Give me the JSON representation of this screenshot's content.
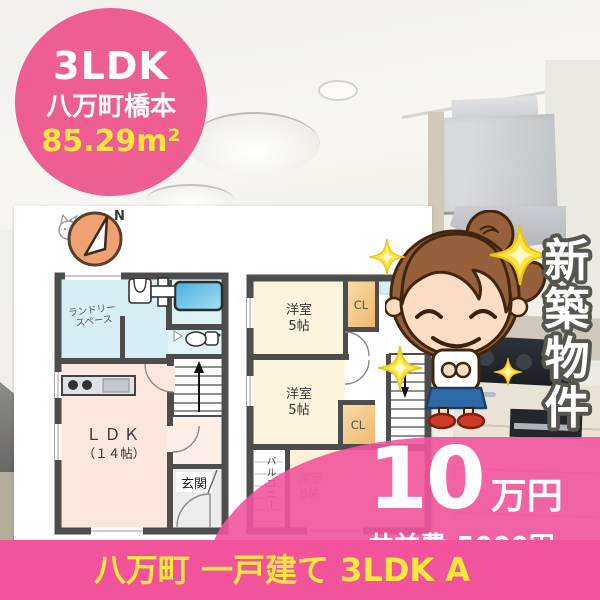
{
  "badge": {
    "layout": "3LDK",
    "location": "八万町橋本",
    "area": "85.29m²"
  },
  "compass": {
    "north_label": "N"
  },
  "floor1": {
    "laundry_line1": "ランドリー",
    "laundry_line2": "スペース",
    "ldk_line1": "ＬＤＫ",
    "ldk_line2": "（１４帖）",
    "entrance": "玄関"
  },
  "floor2": {
    "room_top_line1": "洋室",
    "room_top_line2": "5帖",
    "closet_top": "CL",
    "room_mid_line1": "洋室",
    "room_mid_line2": "5帖",
    "closet_mid": "CL",
    "balcony": "バルコニー",
    "room_bottom_line1": "洋室",
    "room_bottom_line2": "6帖"
  },
  "side_banner": {
    "text": "新築物件",
    "chars": [
      "新",
      "築",
      "物",
      "件"
    ]
  },
  "price": {
    "amount": "10",
    "unit": "万円",
    "maintenance_fee": "共益費:5000円"
  },
  "footer": {
    "caption": "八万町 一戸建て 3LDK A"
  },
  "colors": {
    "brand_pink": "#ee5e93",
    "accent_yellow": "#ffe73e"
  }
}
